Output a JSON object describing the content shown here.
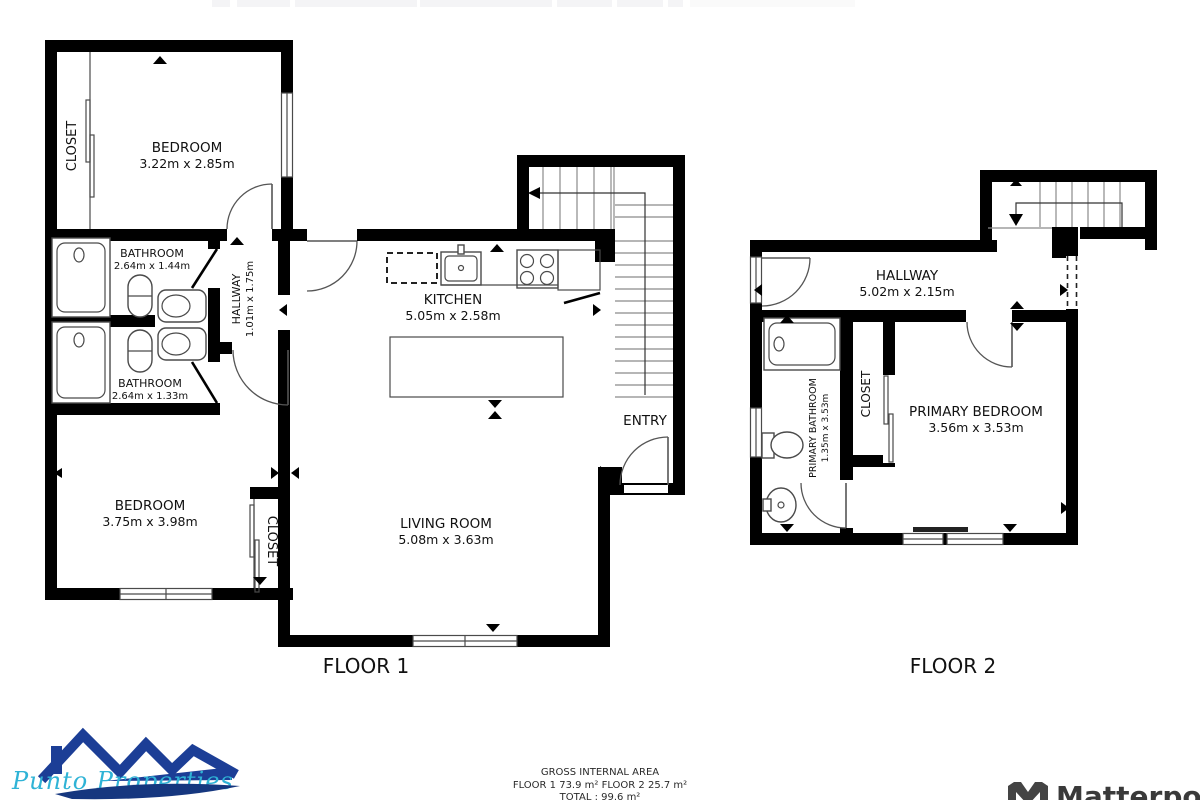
{
  "floor1": {
    "label": "FLOOR 1",
    "rooms": {
      "closet_top": {
        "name": "CLOSET"
      },
      "bedroom_top": {
        "name": "BEDROOM",
        "dims": "3.22m x 2.85m"
      },
      "bathroom_top": {
        "name": "BATHROOM",
        "dims": "2.64m x 1.44m"
      },
      "bathroom_bottom": {
        "name": "BATHROOM",
        "dims": "2.64m x 1.33m"
      },
      "hallway": {
        "name": "HALLWAY",
        "dims": "1.01m x 1.75m"
      },
      "kitchen": {
        "name": "KITCHEN",
        "dims": "5.05m x 2.58m"
      },
      "entry": {
        "name": "ENTRY"
      },
      "bedroom_bottom": {
        "name": "BEDROOM",
        "dims": "3.75m x 3.98m"
      },
      "closet_bottom": {
        "name": "CLOSET"
      },
      "living_room": {
        "name": "LIVING ROOM",
        "dims": "5.08m x 3.63m"
      }
    }
  },
  "floor2": {
    "label": "FLOOR 2",
    "rooms": {
      "hallway": {
        "name": "HALLWAY",
        "dims": "5.02m x 2.15m"
      },
      "primary_bathroom": {
        "name": "PRIMARY BATHROOM",
        "dims": "1.35m x 3.53m"
      },
      "closet": {
        "name": "CLOSET"
      },
      "primary_bedroom": {
        "name": "PRIMARY BEDROOM",
        "dims": "3.56m x 3.53m"
      }
    }
  },
  "footer": {
    "title": "GROSS INTERNAL AREA",
    "floor_areas": "FLOOR 1 73.9 m²   FLOOR 2 25.7 m²",
    "total": "TOTAL :  99.6 m²"
  },
  "branding": {
    "agency_name": "Punto Properties",
    "provider_name": "Matterport"
  },
  "colors": {
    "wall": "#000000",
    "fixture_line": "#4a4a4a",
    "agency_blue": "#1c3e96",
    "agency_cyan": "#2fb3d6",
    "matterport_grey": "#3a3a3a",
    "top_bar": "#f4f4f6"
  }
}
